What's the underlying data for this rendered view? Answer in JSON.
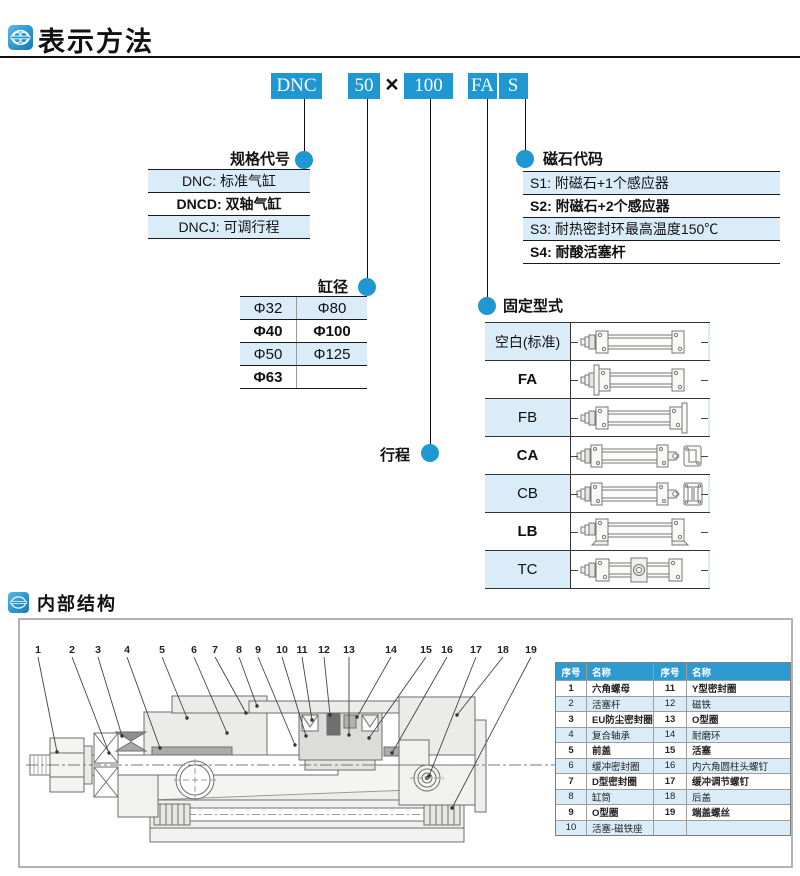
{
  "header": {
    "title": "表示方法"
  },
  "model_code": {
    "segments": [
      "DNC",
      "50",
      "100",
      "FA",
      "S"
    ],
    "separator": "×"
  },
  "spec_table": {
    "label": "规格代号",
    "rows": [
      "DNC: 标准气缸",
      "DNCD: 双轴气缸",
      "DNCJ: 可调行程"
    ]
  },
  "magnet_table": {
    "label": "磁石代码",
    "rows": [
      "S1: 附磁石+1个感应器",
      "S2: 附磁石+2个感应器",
      "S3: 耐热密封环最高温度150℃",
      "S4: 耐酸活塞杆"
    ]
  },
  "bore_table": {
    "label": "缸径",
    "rows": [
      [
        "Φ32",
        "Φ80"
      ],
      [
        "Φ40",
        "Φ100"
      ],
      [
        "Φ50",
        "Φ125"
      ],
      [
        "Φ63",
        ""
      ]
    ]
  },
  "stroke_label": "行程",
  "mounting_table": {
    "label": "固定型式",
    "rows": [
      {
        "label": "空白(标准)",
        "icon": "standard-mount-icon"
      },
      {
        "label": "FA",
        "icon": "front-flange-icon"
      },
      {
        "label": "FB",
        "icon": "rear-flange-icon"
      },
      {
        "label": "CA",
        "icon": "rear-clevis-icon"
      },
      {
        "label": "CB",
        "icon": "double-clevis-icon"
      },
      {
        "label": "LB",
        "icon": "foot-mount-icon"
      },
      {
        "label": "TC",
        "icon": "trunnion-icon"
      }
    ]
  },
  "internal": {
    "title": "内部结构",
    "callouts": [
      "1",
      "2",
      "3",
      "4",
      "5",
      "6",
      "7",
      "8",
      "9",
      "10",
      "11",
      "12",
      "13",
      "14",
      "15",
      "16",
      "17",
      "18",
      "19"
    ]
  },
  "parts_table": {
    "headers": [
      "序号",
      "名称",
      "序号",
      "名称"
    ],
    "rows": [
      [
        "1",
        "六角螺母",
        "11",
        "Y型密封圈"
      ],
      [
        "2",
        "活塞杆",
        "12",
        "磁铁"
      ],
      [
        "3",
        "EU防尘密封圈",
        "13",
        "O型圈"
      ],
      [
        "4",
        "复合轴承",
        "14",
        "耐磨环"
      ],
      [
        "5",
        "前盖",
        "15",
        "活塞"
      ],
      [
        "6",
        "缓冲密封圈",
        "16",
        "内六角圆柱头螺钉"
      ],
      [
        "7",
        "D型密封圈",
        "17",
        "缓冲调节螺钉"
      ],
      [
        "8",
        "缸筒",
        "18",
        "后盖"
      ],
      [
        "9",
        "O型圈",
        "19",
        "端盖螺丝"
      ],
      [
        "10",
        "活塞-磁铁座",
        "",
        ""
      ]
    ]
  },
  "colors": {
    "accent": "#1E97D3",
    "row_light": "#D9ECF8",
    "header_blue": "#2E9AD2"
  }
}
